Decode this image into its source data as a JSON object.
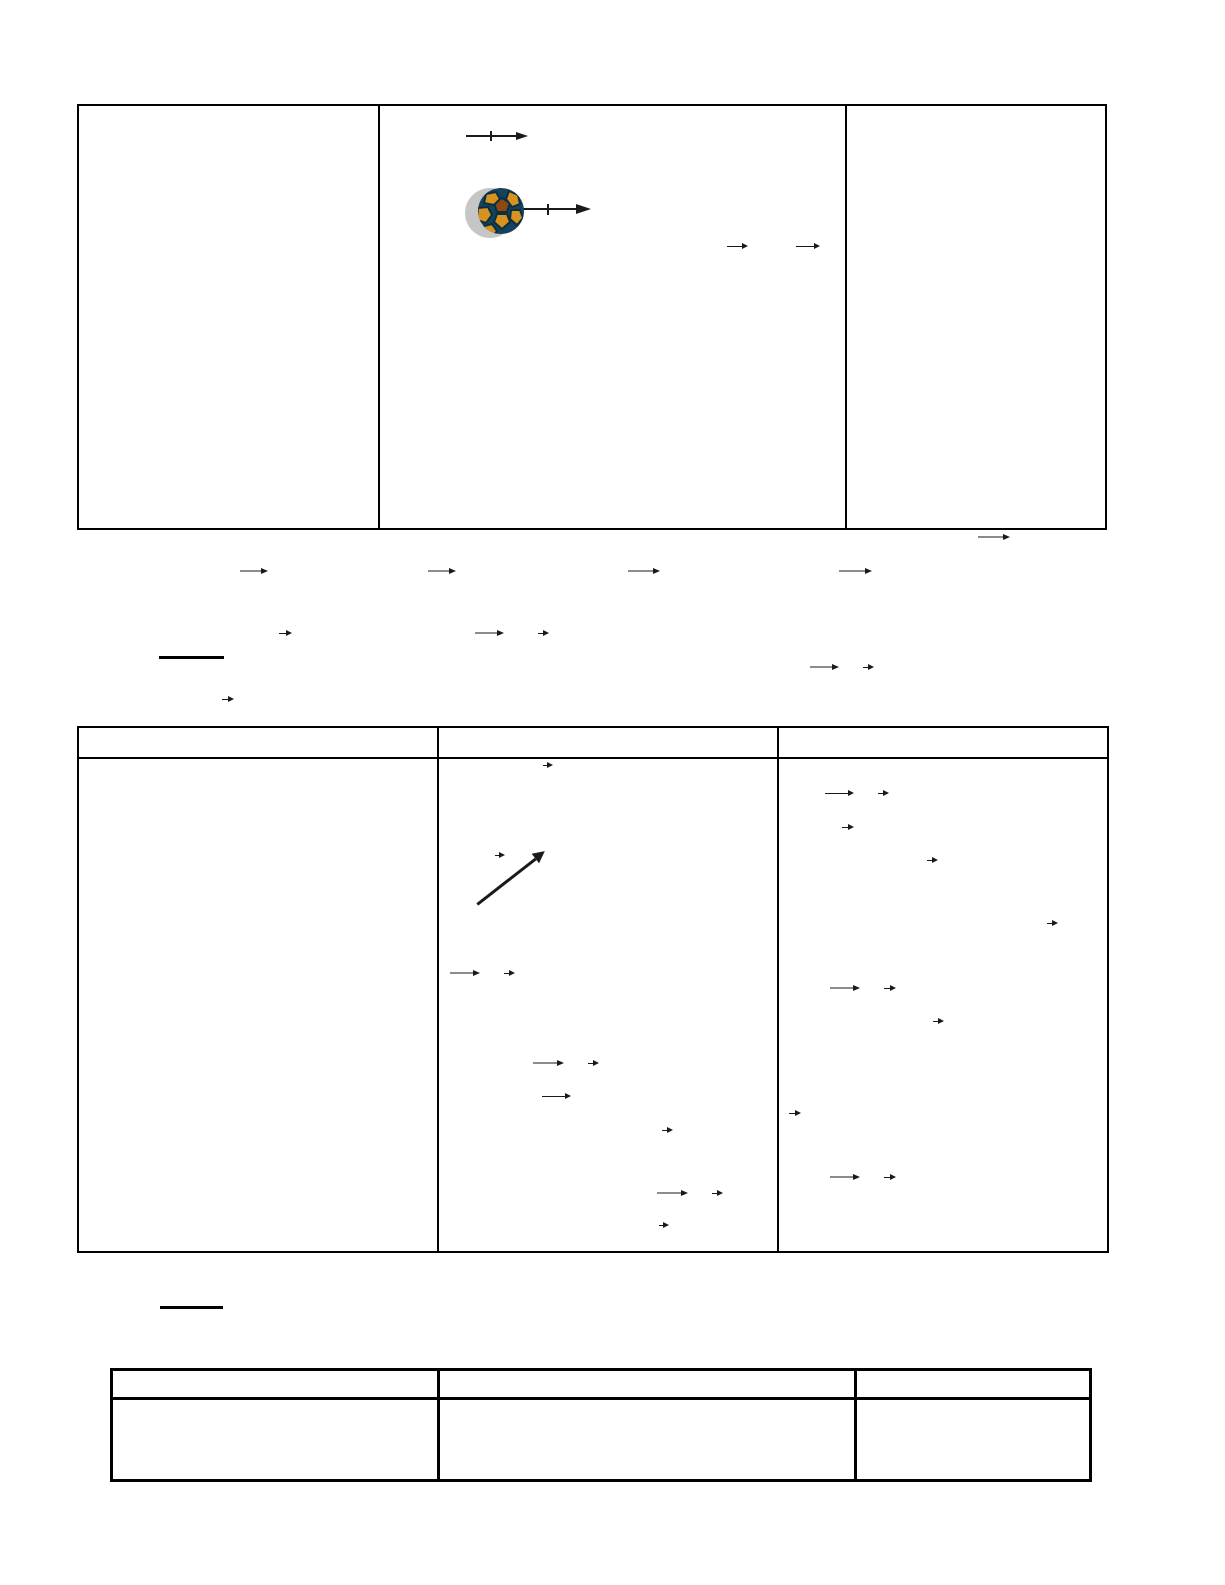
{
  "page": {
    "width": 1225,
    "height": 1585
  },
  "colors": {
    "page_bg": "#ffffff",
    "border": "#000000",
    "arrow_gray": "#8c8c8c",
    "arrow_dark": "#1a1a1a",
    "underline": "#000000",
    "ball_shadow": "#c6c6c6",
    "ball_base": "#16425c",
    "ball_line": "#0b2e42",
    "ball_patch": "#d8931f",
    "ball_patch_dark": "#8a4a10"
  },
  "tables": [
    {
      "name": "top-table",
      "x": 77,
      "y": 104,
      "width": 1030,
      "height": 426,
      "border": 2,
      "divider": 2,
      "column_dividers": [
        378,
        845
      ],
      "header_divider_y": null,
      "columns": 3,
      "cells_text": [
        "",
        "",
        ""
      ]
    },
    {
      "name": "middle-table",
      "x": 77,
      "y": 726,
      "width": 1032,
      "height": 527,
      "border": 2,
      "divider": 2,
      "column_dividers": [
        437,
        777
      ],
      "header_divider_y": 757,
      "columns": 3,
      "header_text": [
        "",
        "",
        ""
      ],
      "cells_text": [
        "",
        "",
        ""
      ]
    },
    {
      "name": "bottom-table",
      "x": 110,
      "y": 1368,
      "width": 982,
      "height": 114,
      "border": 3,
      "divider": 3,
      "column_dividers": [
        437,
        854
      ],
      "header_divider_y": 1397,
      "columns": 3,
      "header_text": [
        "",
        "",
        ""
      ],
      "cells_text": [
        "",
        "",
        ""
      ]
    }
  ],
  "soccer_ball": {
    "x": 464,
    "y": 186,
    "width": 62,
    "height": 52
  },
  "ticked_arrows": [
    {
      "x1": 466,
      "y": 136,
      "x2": 528,
      "tick": 490,
      "head": 12,
      "tick_h": 10
    },
    {
      "x1": 523,
      "y": 209,
      "x2": 591,
      "tick": 547,
      "head": 15,
      "tick_h": 11
    }
  ],
  "diagonal_arrow": {
    "x1": 477,
    "y1": 904,
    "x2": 545,
    "y2": 851,
    "thickness": 3,
    "head": 12
  },
  "vector_arrows": [
    {
      "x": 727,
      "y": 246,
      "len": 21,
      "shade": "dark"
    },
    {
      "x": 796,
      "y": 246,
      "len": 24,
      "shade": "dark"
    },
    {
      "x": 978,
      "y": 537,
      "len": 32,
      "shade": "gray"
    },
    {
      "x": 240,
      "y": 571,
      "len": 28,
      "shade": "gray"
    },
    {
      "x": 428,
      "y": 571,
      "len": 28,
      "shade": "gray"
    },
    {
      "x": 628,
      "y": 571,
      "len": 32,
      "shade": "gray"
    },
    {
      "x": 839,
      "y": 571,
      "len": 33,
      "shade": "gray"
    },
    {
      "x": 279,
      "y": 633,
      "len": 13,
      "shade": "dark"
    },
    {
      "x": 475,
      "y": 633,
      "len": 29,
      "shade": "gray"
    },
    {
      "x": 538,
      "y": 633,
      "len": 11,
      "shade": "dark"
    },
    {
      "x": 810,
      "y": 667,
      "len": 29,
      "shade": "gray"
    },
    {
      "x": 863,
      "y": 667,
      "len": 11,
      "shade": "dark"
    },
    {
      "x": 222,
      "y": 699,
      "len": 12,
      "shade": "dark"
    },
    {
      "x": 543,
      "y": 765,
      "len": 10,
      "shade": "dark"
    },
    {
      "x": 495,
      "y": 855,
      "len": 10,
      "shade": "dark"
    },
    {
      "x": 450,
      "y": 973,
      "len": 30,
      "shade": "gray"
    },
    {
      "x": 504,
      "y": 973,
      "len": 11,
      "shade": "dark"
    },
    {
      "x": 533,
      "y": 1063,
      "len": 31,
      "shade": "gray"
    },
    {
      "x": 588,
      "y": 1063,
      "len": 11,
      "shade": "dark"
    },
    {
      "x": 542,
      "y": 1096,
      "len": 29,
      "shade": "dark"
    },
    {
      "x": 662,
      "y": 1130,
      "len": 11,
      "shade": "dark"
    },
    {
      "x": 657,
      "y": 1193,
      "len": 31,
      "shade": "gray"
    },
    {
      "x": 712,
      "y": 1193,
      "len": 11,
      "shade": "dark"
    },
    {
      "x": 659,
      "y": 1225,
      "len": 10,
      "shade": "dark"
    },
    {
      "x": 825,
      "y": 793,
      "len": 29,
      "shade": "dark"
    },
    {
      "x": 878,
      "y": 793,
      "len": 11,
      "shade": "dark"
    },
    {
      "x": 842,
      "y": 827,
      "len": 12,
      "shade": "dark"
    },
    {
      "x": 927,
      "y": 860,
      "len": 11,
      "shade": "dark"
    },
    {
      "x": 1047,
      "y": 923,
      "len": 11,
      "shade": "dark"
    },
    {
      "x": 830,
      "y": 988,
      "len": 30,
      "shade": "gray"
    },
    {
      "x": 884,
      "y": 988,
      "len": 12,
      "shade": "dark"
    },
    {
      "x": 933,
      "y": 1021,
      "len": 11,
      "shade": "dark"
    },
    {
      "x": 789,
      "y": 1113,
      "len": 12,
      "shade": "dark"
    },
    {
      "x": 830,
      "y": 1177,
      "len": 30,
      "shade": "gray"
    },
    {
      "x": 884,
      "y": 1177,
      "len": 12,
      "shade": "dark"
    }
  ],
  "underlines": [
    {
      "x": 159,
      "y": 656,
      "width": 65,
      "height": 3
    },
    {
      "x": 160,
      "y": 1306,
      "width": 63,
      "height": 3
    }
  ]
}
